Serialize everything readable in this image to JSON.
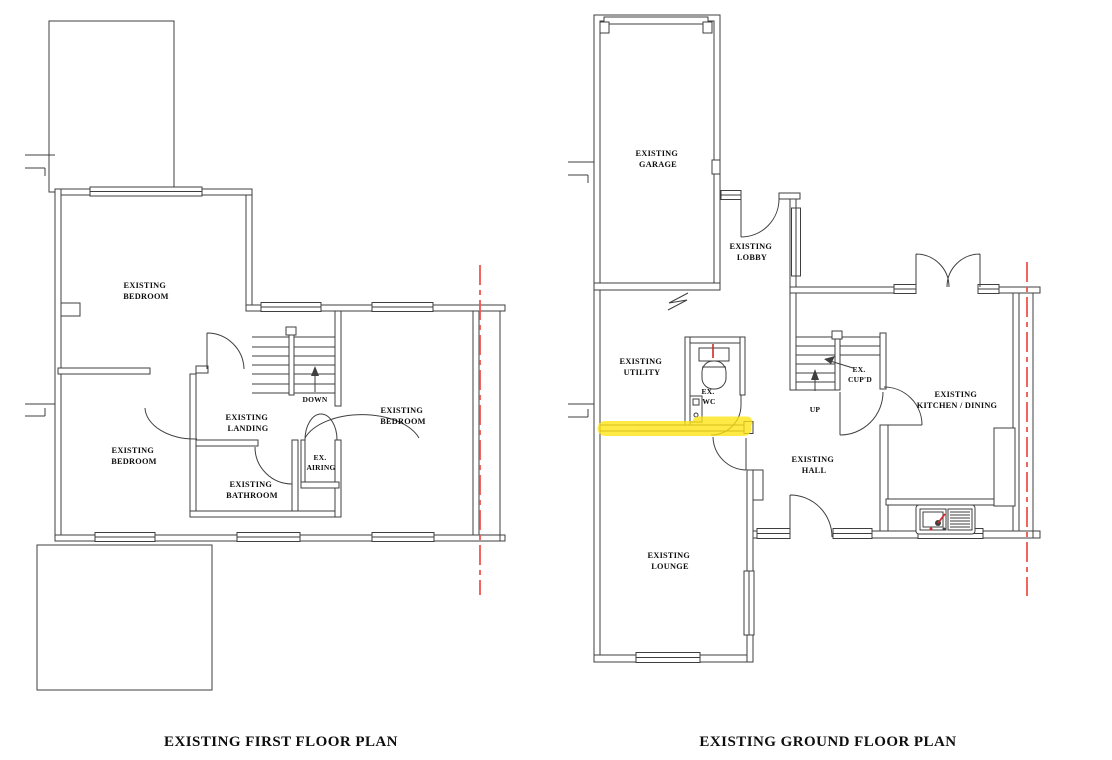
{
  "colors": {
    "line": "#3f3f3f",
    "text": "#0e0e0e",
    "section_line_red": "#f0544c",
    "highlight_yellow": "#ffe412",
    "fixture_red": "#cc2a2a"
  },
  "first_floor": {
    "title": "EXISTING FIRST FLOOR PLAN",
    "rooms": {
      "bedroom_top_left": {
        "l1": "EXISTING",
        "l2": "BEDROOM"
      },
      "bedroom_bottom_left": {
        "l1": "EXISTING",
        "l2": "BEDROOM"
      },
      "bedroom_right": {
        "l1": "EXISTING",
        "l2": "BEDROOM"
      },
      "landing": {
        "l1": "EXISTING",
        "l2": "LANDING"
      },
      "bathroom": {
        "l1": "EXISTING",
        "l2": "BATHROOM"
      },
      "airing": {
        "l1": "EX.",
        "l2": "AIRING"
      },
      "stairs": "DOWN"
    }
  },
  "ground_floor": {
    "title": "EXISTING GROUND FLOOR PLAN",
    "rooms": {
      "garage": {
        "l1": "EXISTING",
        "l2": "GARAGE"
      },
      "lobby": {
        "l1": "EXISTING",
        "l2": "LOBBY"
      },
      "utility": {
        "l1": "EXISTING",
        "l2": "UTILITY"
      },
      "wc": {
        "l1": "EX.",
        "l2": "WC"
      },
      "cupboard": {
        "l1": "EX.",
        "l2": "CUP'D"
      },
      "stairs": "UP",
      "kitchen": {
        "l1": "EXISTING",
        "l2": "KITCHEN / DINING"
      },
      "hall": {
        "l1": "EXISTING",
        "l2": "HALL"
      },
      "lounge": {
        "l1": "EXISTING",
        "l2": "LOUNGE"
      }
    }
  }
}
